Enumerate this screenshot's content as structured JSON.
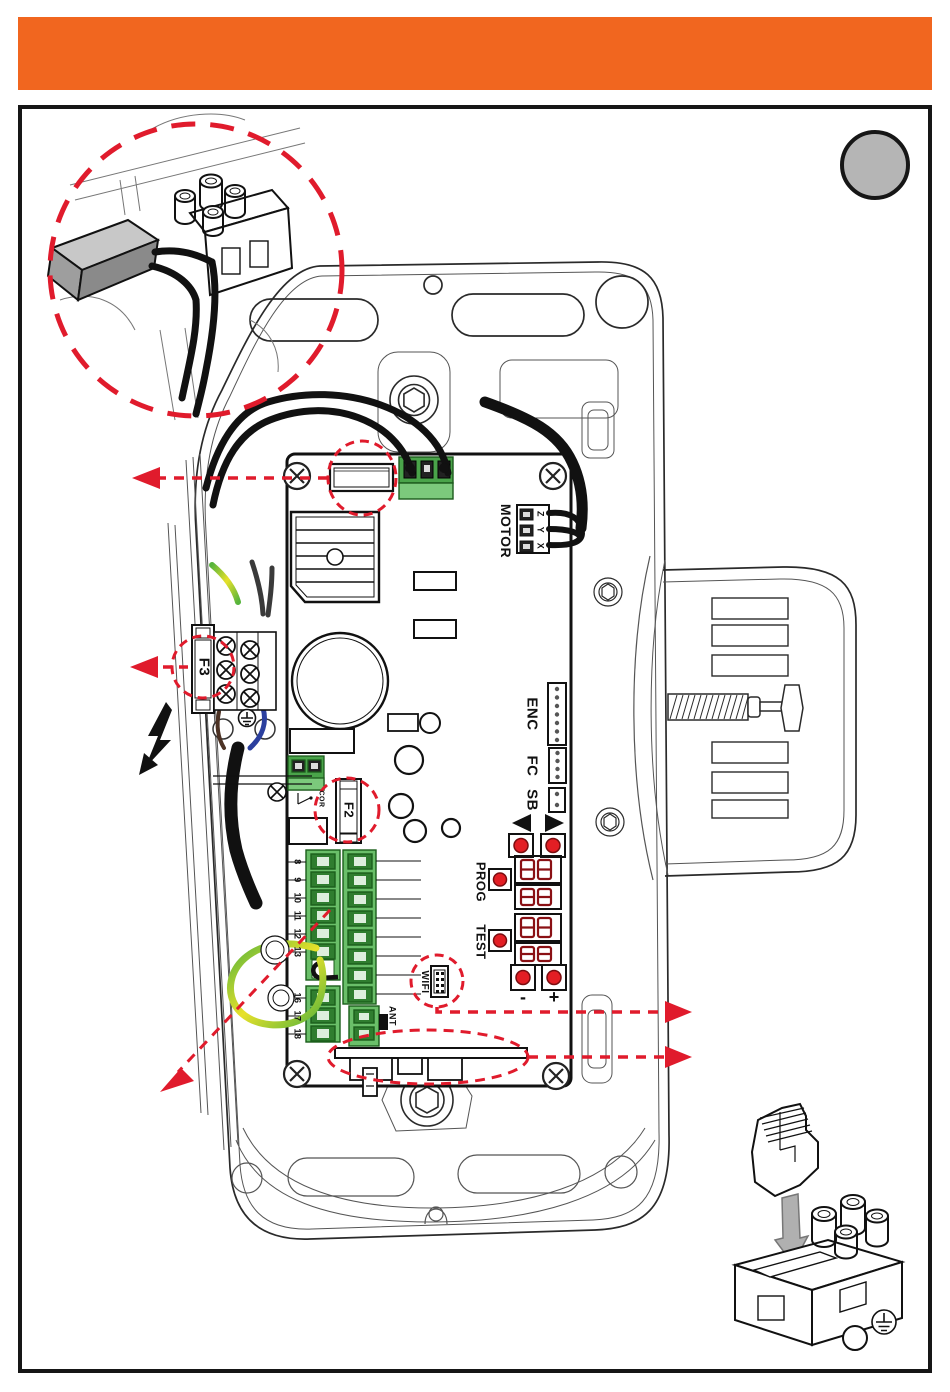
{
  "colors": {
    "accent_orange": "#F1661F",
    "annotation_red": "#E01B2C",
    "terminal_green": "#4AA44A",
    "badge_gray": "#B5B5B5",
    "display_red": "#8A1014"
  },
  "board": {
    "motor_label": "MOTOR",
    "motor_pins": [
      "Z",
      "Y",
      "X"
    ],
    "enc_label": "ENC",
    "fc_label": "FC",
    "sb_label": "SB",
    "prog_label": "PROG",
    "test_label": "TEST",
    "wifi_label": "WIFI",
    "minus_label": "-",
    "plus_label": "+",
    "fuse_f2_label": "F2",
    "fuse_f3_label": "F3",
    "cor_label": "COR",
    "ant_label": "ANT",
    "terminals_upper": [
      "8",
      "9",
      "10",
      "11",
      "12",
      "13"
    ],
    "terminals_lower": [
      "16",
      "17",
      "18"
    ]
  }
}
